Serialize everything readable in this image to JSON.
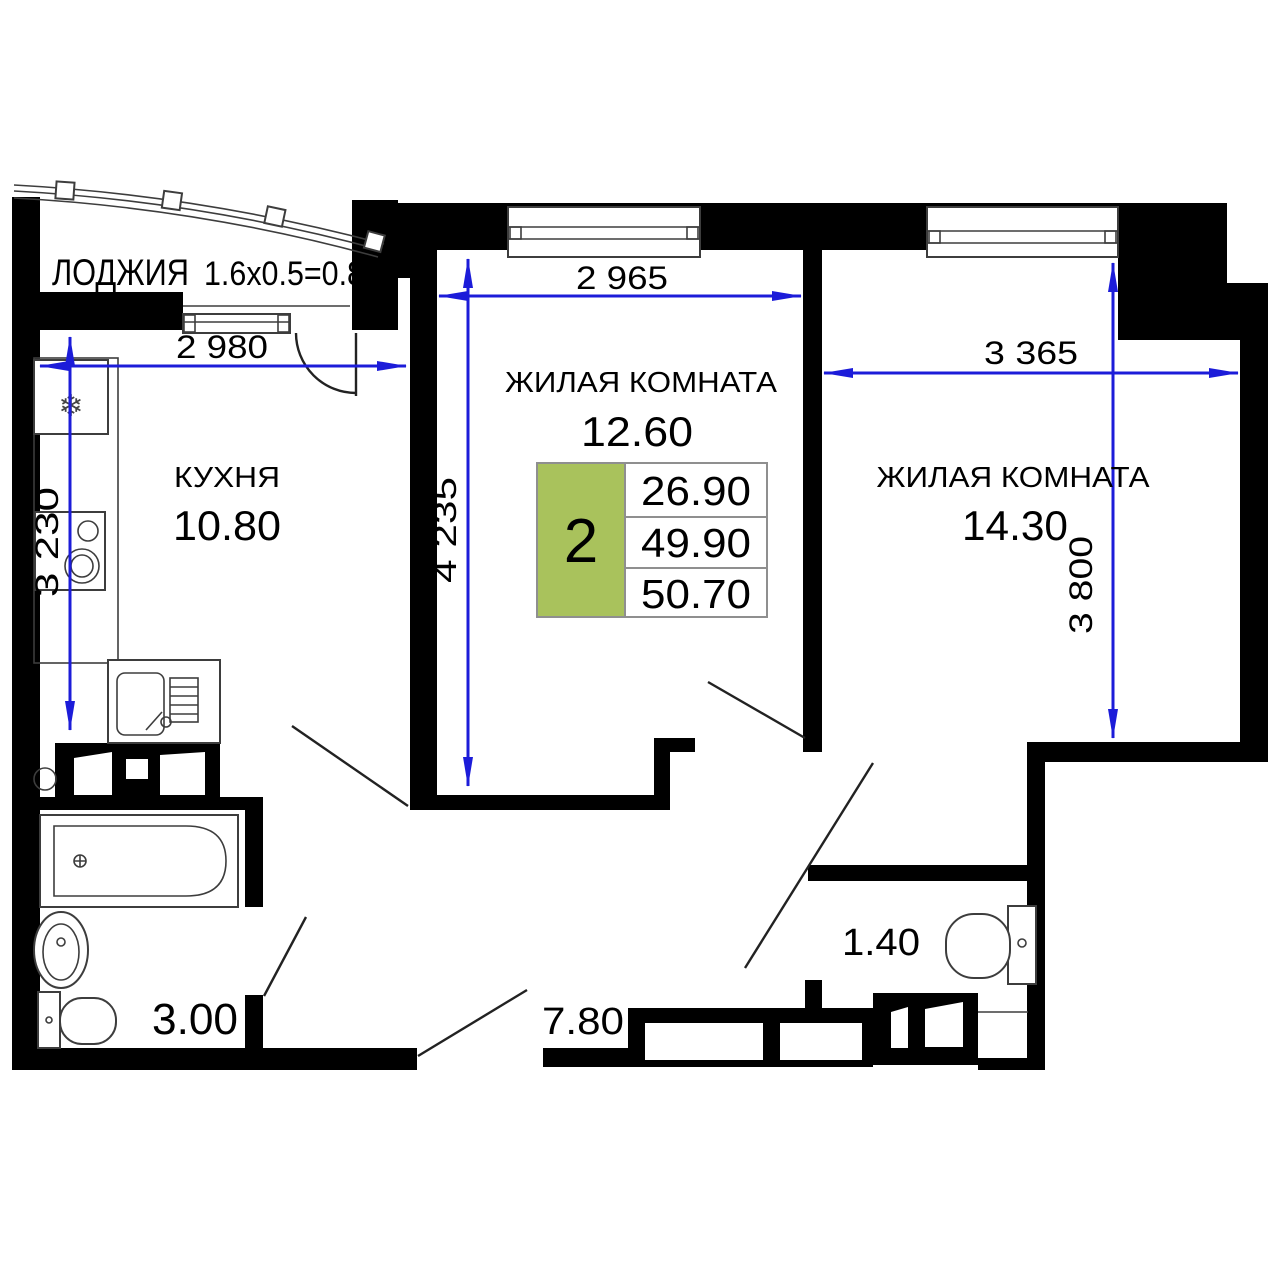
{
  "plan": {
    "loggia": {
      "label": "ЛОДЖИЯ",
      "formula": "1.6x0.5=0.8"
    },
    "kitchen": {
      "label": "КУХНЯ",
      "area": "10.80"
    },
    "living_room_1": {
      "label": "ЖИЛАЯ КОМНАТА",
      "area": "12.60"
    },
    "living_room_2": {
      "label": "ЖИЛАЯ КОМНАТА",
      "area": "14.30"
    },
    "bathroom": {
      "area": "3.00"
    },
    "hallway": {
      "area": "7.80"
    },
    "wc": {
      "area": "1.40"
    }
  },
  "dimensions": {
    "kitchen_width": "2 980",
    "kitchen_depth": "3 230",
    "living1_width": "2 965",
    "living1_depth": "4 235",
    "living2_width": "3 365",
    "living2_depth": "3 800"
  },
  "summary": {
    "rooms": "2",
    "living_area": "26.90",
    "floor_area": "49.90",
    "total_area": "50.70"
  },
  "colors": {
    "wall": "#000000",
    "dim": "#1c1cd9",
    "accent": "#a9c25c",
    "line": "#3d3d3d",
    "border": "#8f8f8f",
    "text": "#000000",
    "bg": "#ffffff"
  }
}
